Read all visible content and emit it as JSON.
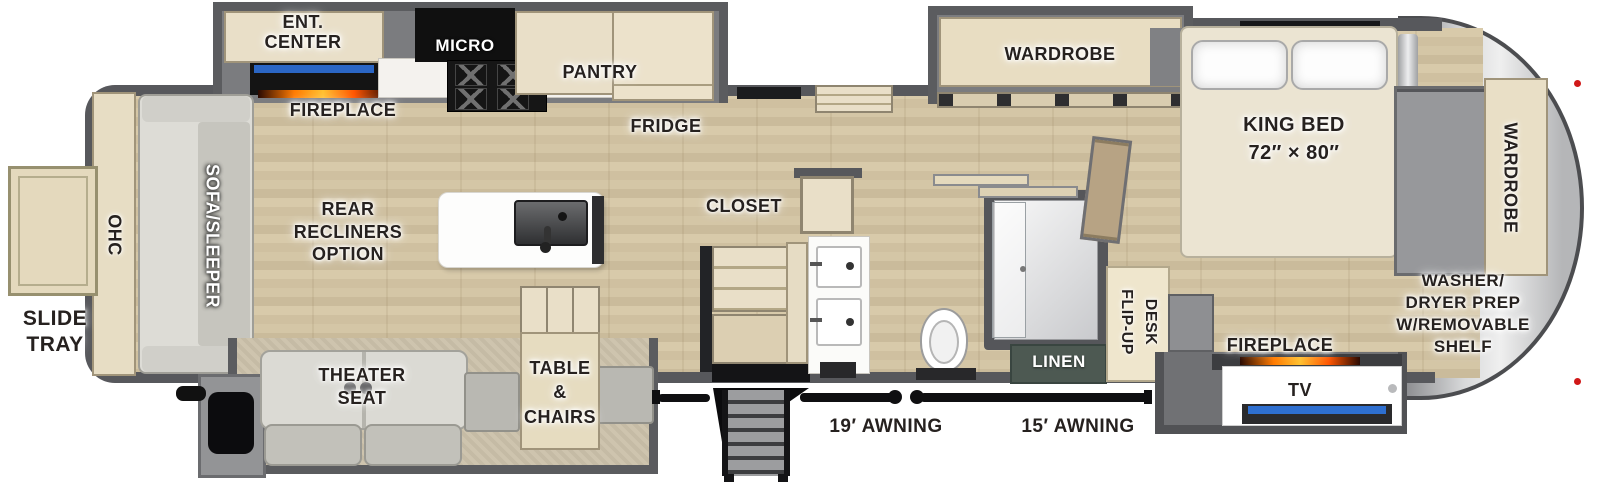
{
  "floorplan": {
    "labels": {
      "slide_tray": "SLIDE\nTRAY",
      "ohc": "OHC",
      "sofa_sleeper": "SOFA/SLEEPER",
      "ent_center": "ENT.\nCENTER",
      "fireplace_rear": "FIREPLACE",
      "micro": "MICRO",
      "pantry": "PANTRY",
      "fridge": "FRIDGE",
      "rear_recliners_option": "REAR\nRECLINERS\nOPTION",
      "closet": "CLOSET",
      "theater_seat": "THEATER\nSEAT",
      "table_chairs": "TABLE\n&\nCHAIRS",
      "awning_19": "19′ AWNING",
      "awning_15": "15′ AWNING",
      "linen": "LINEN",
      "flip_up": "FLIP-UP",
      "desk": "DESK",
      "fireplace_front": "FIREPLACE",
      "tv": "TV",
      "king_bed": "KING BED",
      "king_bed_size": "72″ × 80″",
      "wardrobe_slide": "WARDROBE",
      "wardrobe_front": "WARDROBE",
      "washer_dryer": "WASHER/\nDRYER PREP\nW/REMOVABLE\nSHELF"
    },
    "colors": {
      "wall": "#57585c",
      "slide_wall": "#5b5c5f",
      "floor_wood": "#d3c5a5",
      "cabinet": "#e9dfc8",
      "counter": "#ffffff",
      "appliance_black": "#141414",
      "tv_blue": "#2e6fd0",
      "fire_orange": "#ff7a00",
      "linen_green": "#4d5952",
      "front_cap_silver": "#d8d9da",
      "marker_red": "#d01818"
    }
  }
}
